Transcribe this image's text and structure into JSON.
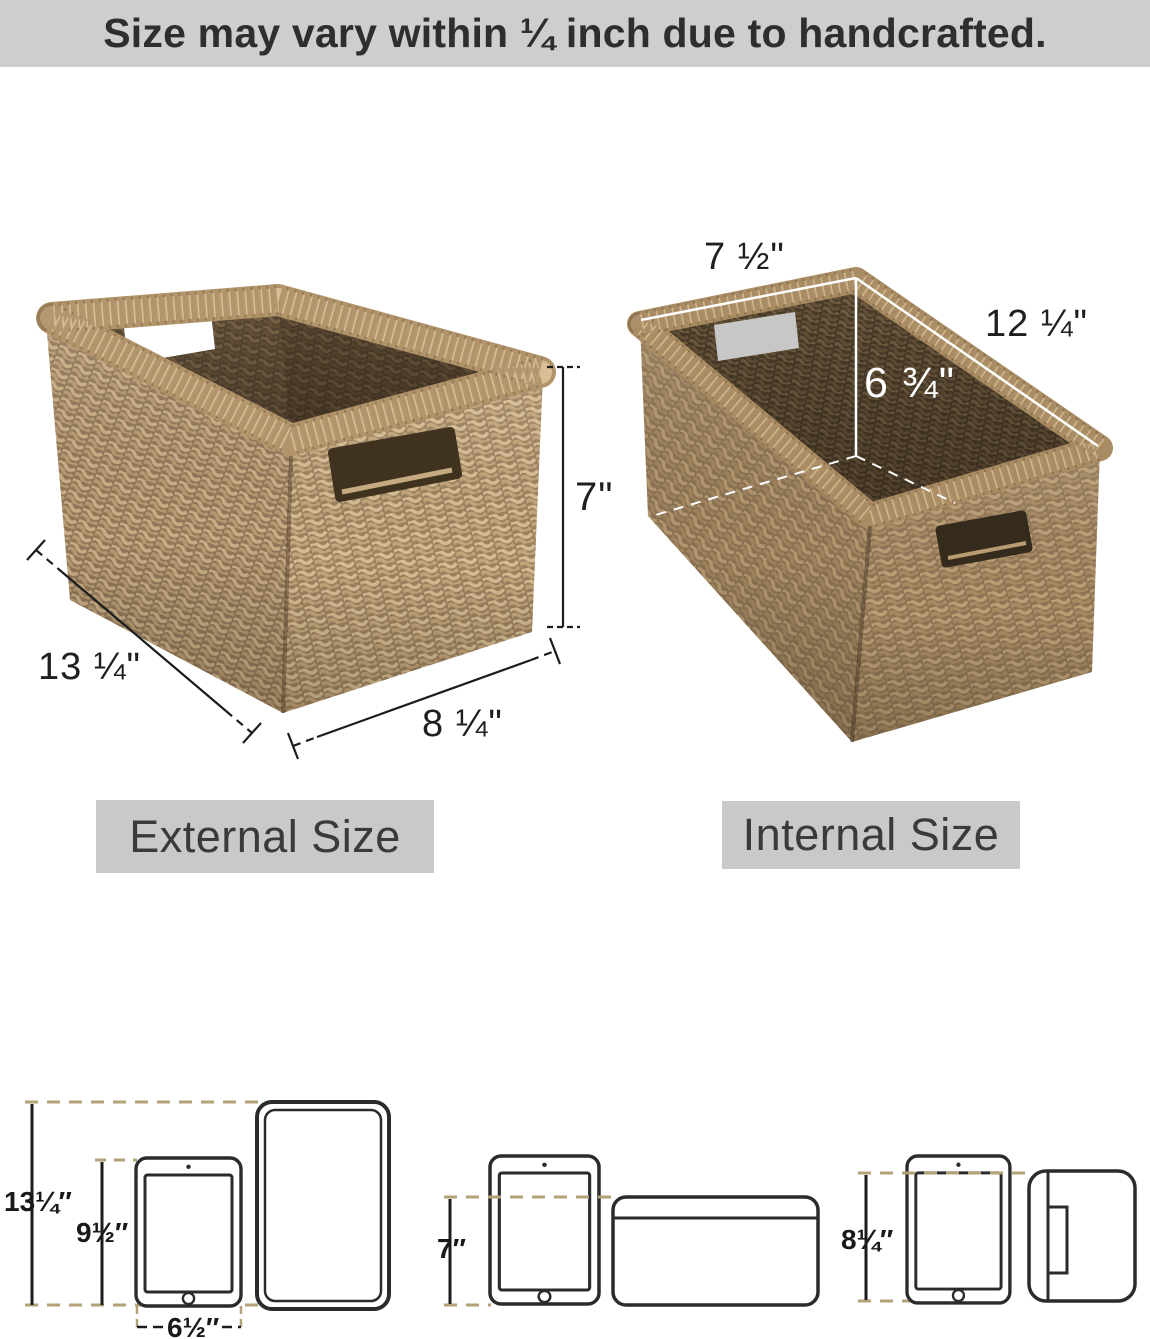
{
  "banner": {
    "text": "Size may vary within ¼ inch due to handcrafted."
  },
  "external_basket": {
    "label": "External Size",
    "height": "7\"",
    "length": "13 ¼\"",
    "width": "8 ¼\""
  },
  "internal_basket": {
    "label": "Internal Size",
    "width": "7 ½\"",
    "length": "12 ¼\"",
    "height": "6 ¾\""
  },
  "size_comparison": {
    "left": {
      "basket_height": "13¼″",
      "tablet_height": "9½″",
      "tablet_width": "6½″"
    },
    "middle": {
      "basket_height": "7″"
    },
    "right": {
      "basket_height": "8¼″"
    }
  },
  "colors": {
    "banner_bg": "#cecece",
    "banner_text": "#2e2e2e",
    "label_bg": "#c9c9c9",
    "dash_tan": "#b3a177",
    "diagram_line": "#2b2b2b",
    "internal_dim_line": "#ffffff",
    "external_dim_line": "#1c1c1c"
  }
}
